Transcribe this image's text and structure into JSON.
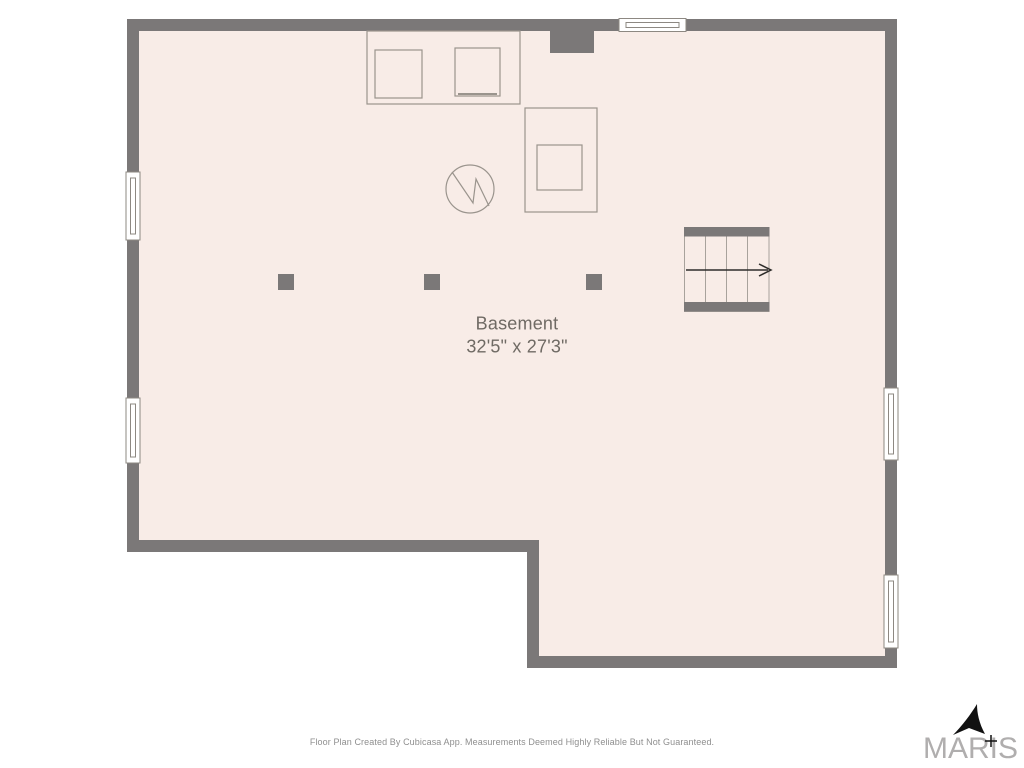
{
  "colors": {
    "wall": "#7b7878",
    "floor": "#f8ece7",
    "fixture_outline": "#9a948d",
    "window_frame": "#8d8882",
    "stair_line": "#a8a29c",
    "stair_arrow": "#2e2d2b",
    "room_text": "#6f6a64",
    "footer_text": "#8f8f8f",
    "logo_text": "#b0aeae",
    "logo_arrow": "#111111"
  },
  "room": {
    "name": "Basement",
    "dimensions": "32'5\" x 27'3\""
  },
  "footer": {
    "disclaimer": "Floor Plan Created By Cubicasa App. Measurements Deemed Highly Reliable But Not Guaranteed."
  },
  "branding": {
    "logo_text": "MARIS"
  },
  "icons": {
    "water_heater": "circle-zigzag",
    "stair_direction": "arrow-right",
    "compass": "northeast-arrowhead-with-cross"
  }
}
